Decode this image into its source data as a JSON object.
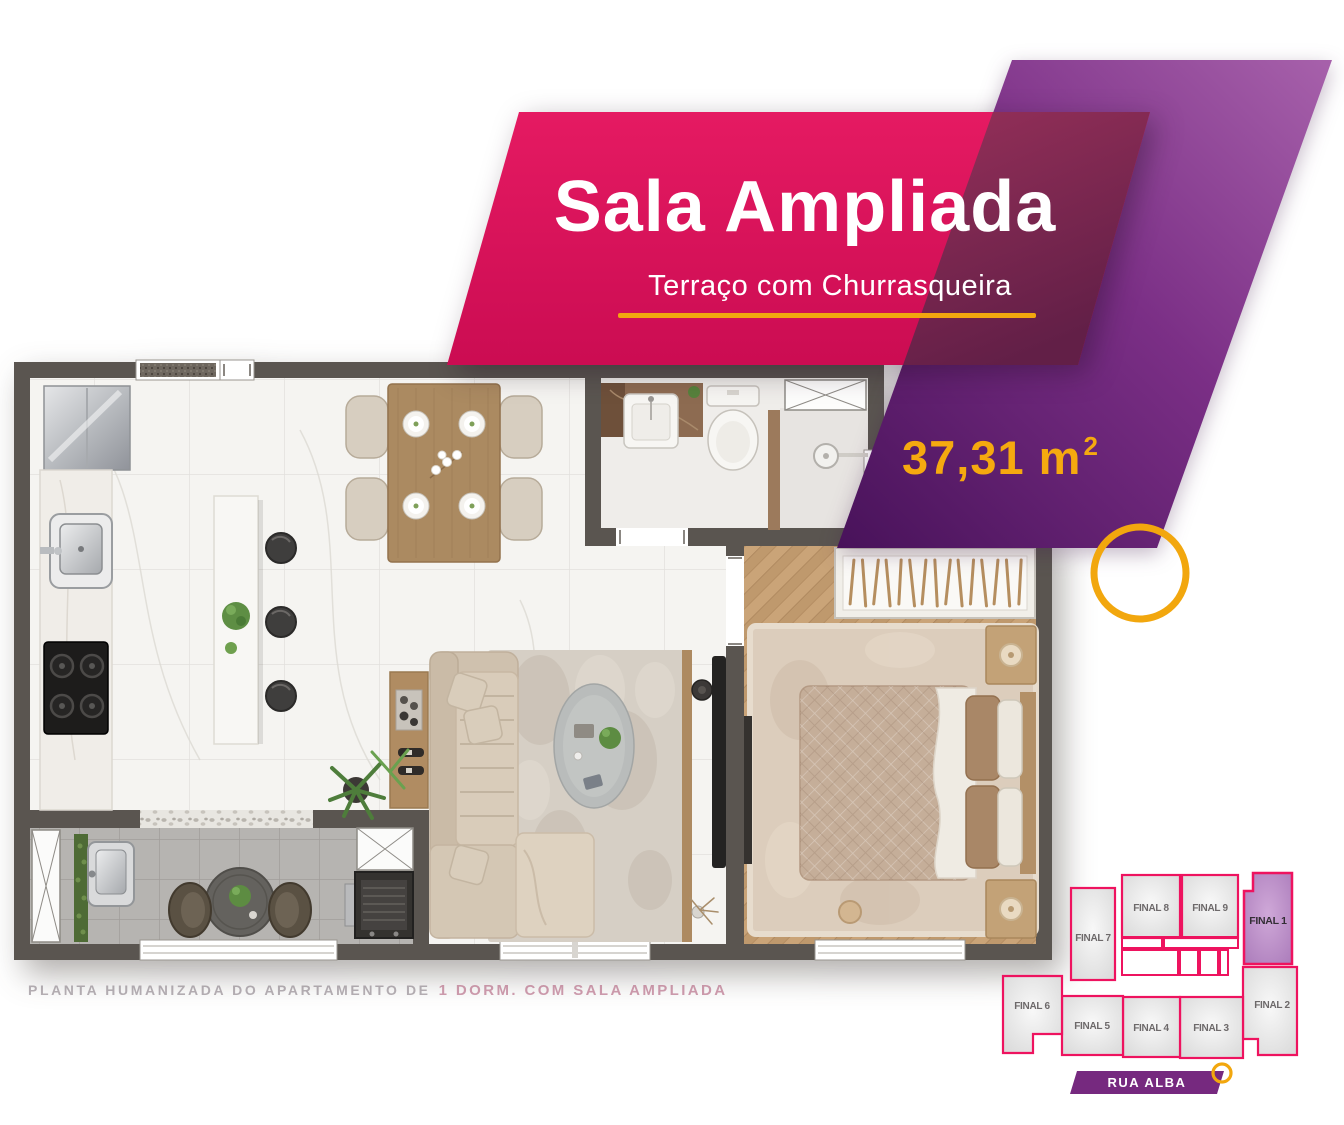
{
  "banner": {
    "title": "Sala Ampliada",
    "subtitle": "Terraço com Churrasqueira",
    "area_value": "37,31 m",
    "area_sup": "2"
  },
  "caption": {
    "prefix": "PLANTA HUMANIZADA DO APARTAMENTO DE",
    "highlight": "1 DORM. COM SALA AMPLIADA"
  },
  "keyplan": {
    "street_label": "RUA ALBA",
    "highlighted_unit": "FINAL 1",
    "units": [
      {
        "label": "FINAL 7"
      },
      {
        "label": "FINAL 8"
      },
      {
        "label": "FINAL 9"
      },
      {
        "label": "FINAL 1"
      },
      {
        "label": "FINAL 2"
      },
      {
        "label": "FINAL 3"
      },
      {
        "label": "FINAL 4"
      },
      {
        "label": "FINAL 5"
      },
      {
        "label": "FINAL 6"
      }
    ]
  },
  "colors": {
    "pink": "#df1159",
    "maroon_overlap": "#7c2750",
    "purple_dark": "#4a1458",
    "purple_light": "#a761ab",
    "yellow": "#f2a70e",
    "wall": "#5a5550",
    "keyplan_stroke": "#ee135f",
    "street_banner": "#76297f"
  }
}
